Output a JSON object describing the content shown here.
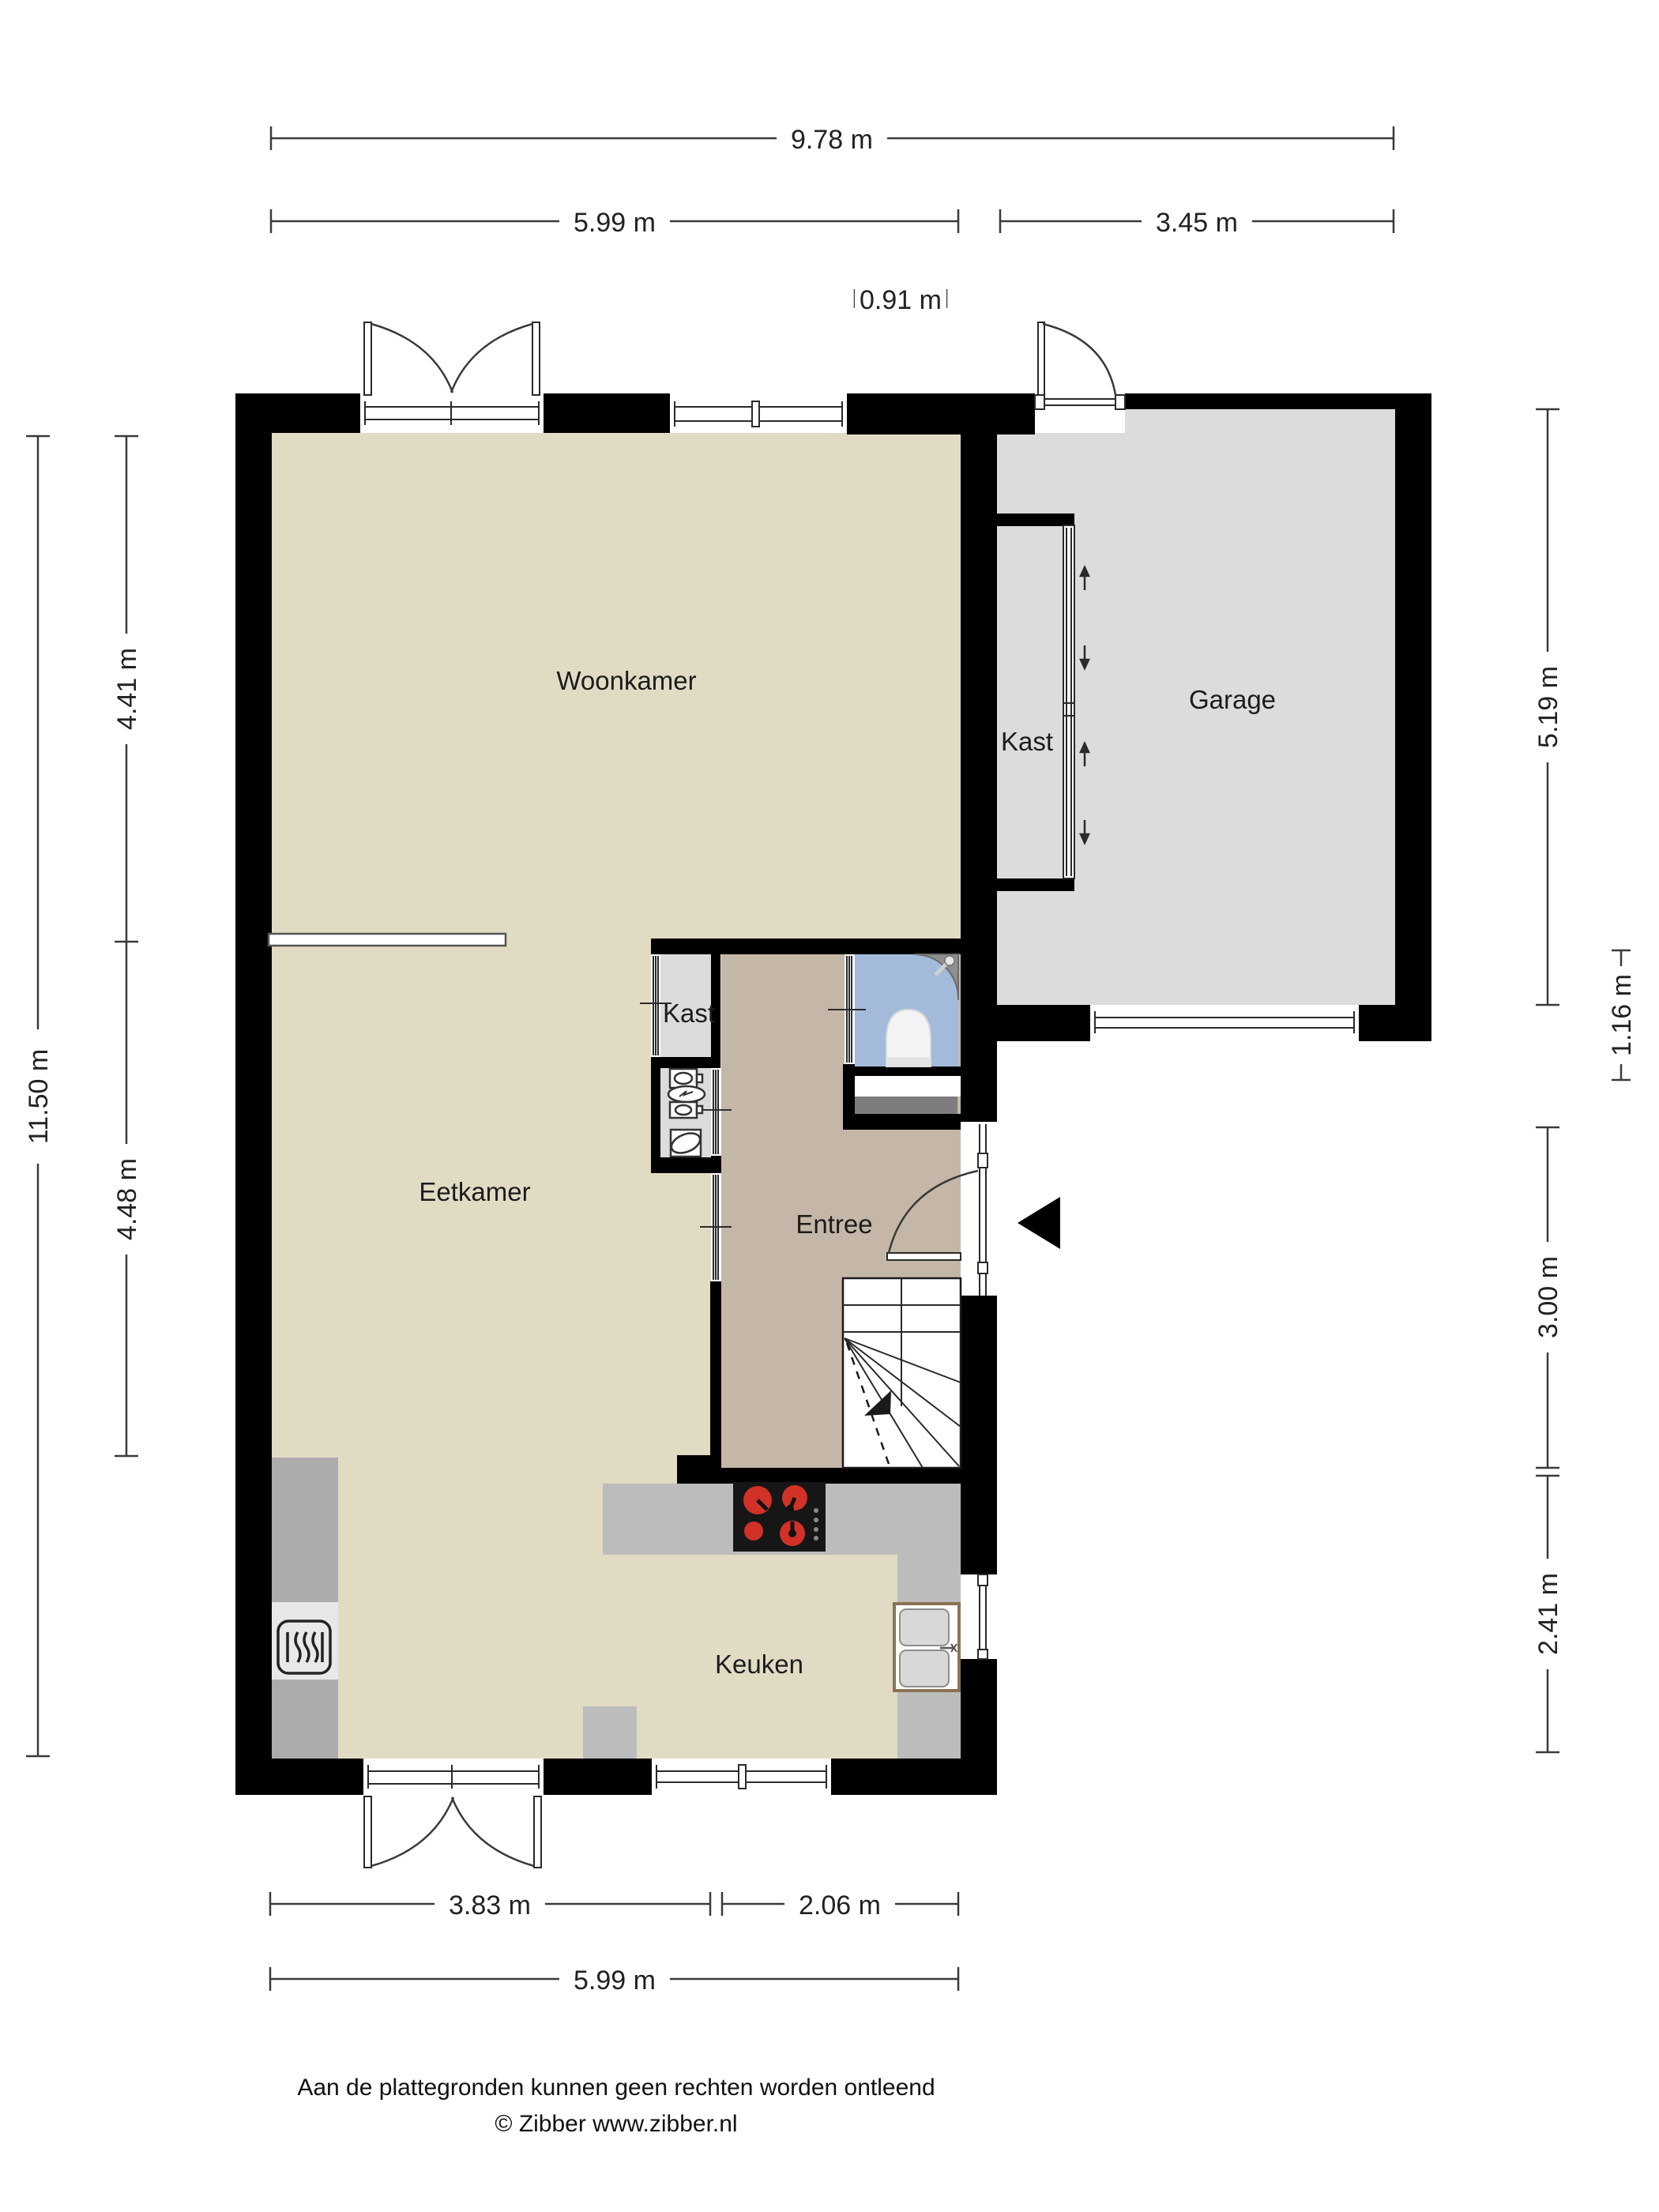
{
  "plan_title": "Begane grond plattegrond",
  "colors": {
    "wall": "#000000",
    "floor_main": "#e1dbc4",
    "floor_entree": "#c5b7a7",
    "floor_toilet": "#a4badb",
    "floor_garage": "#dcdcdc",
    "floor_kast": "#dcdcdc",
    "counter": "#bcbcbc",
    "cabinet": "#acacac",
    "cabinet_light": "#e8e8e8",
    "radiator": "#7d7d7d",
    "stove": "#161616",
    "burner_red": "#d23127",
    "basin_gray": "#d8d8d8",
    "sink_border": "#8a7355",
    "washbasin": "#8f8f8f",
    "toilet_white": "#f4f4f4"
  },
  "rooms": {
    "woonkamer": "Woonkamer",
    "eetkamer": "Eetkamer",
    "keuken": "Keuken",
    "entree": "Entree",
    "garage": "Garage",
    "kast_garage": "Kast",
    "kast_hal": "Kast"
  },
  "dims": {
    "top_total": "9.78 m",
    "top_left": "5.99 m",
    "top_right": "3.45 m",
    "top_small": "0.91 m",
    "left_total": "11.50 m",
    "left_upper": "4.41 m",
    "left_lower": "4.48 m",
    "right_garage": "5.19 m",
    "right_small": "1.16 m",
    "right_entree": "3.00 m",
    "right_kitchen": "2.41 m",
    "bottom_left": "3.83 m",
    "bottom_right": "2.06 m",
    "bottom_total": "5.99 m"
  },
  "footer": {
    "disclaimer": "Aan de plattegronden kunnen geen rechten worden ontleend",
    "copyright": "© Zibber www.zibber.nl"
  }
}
